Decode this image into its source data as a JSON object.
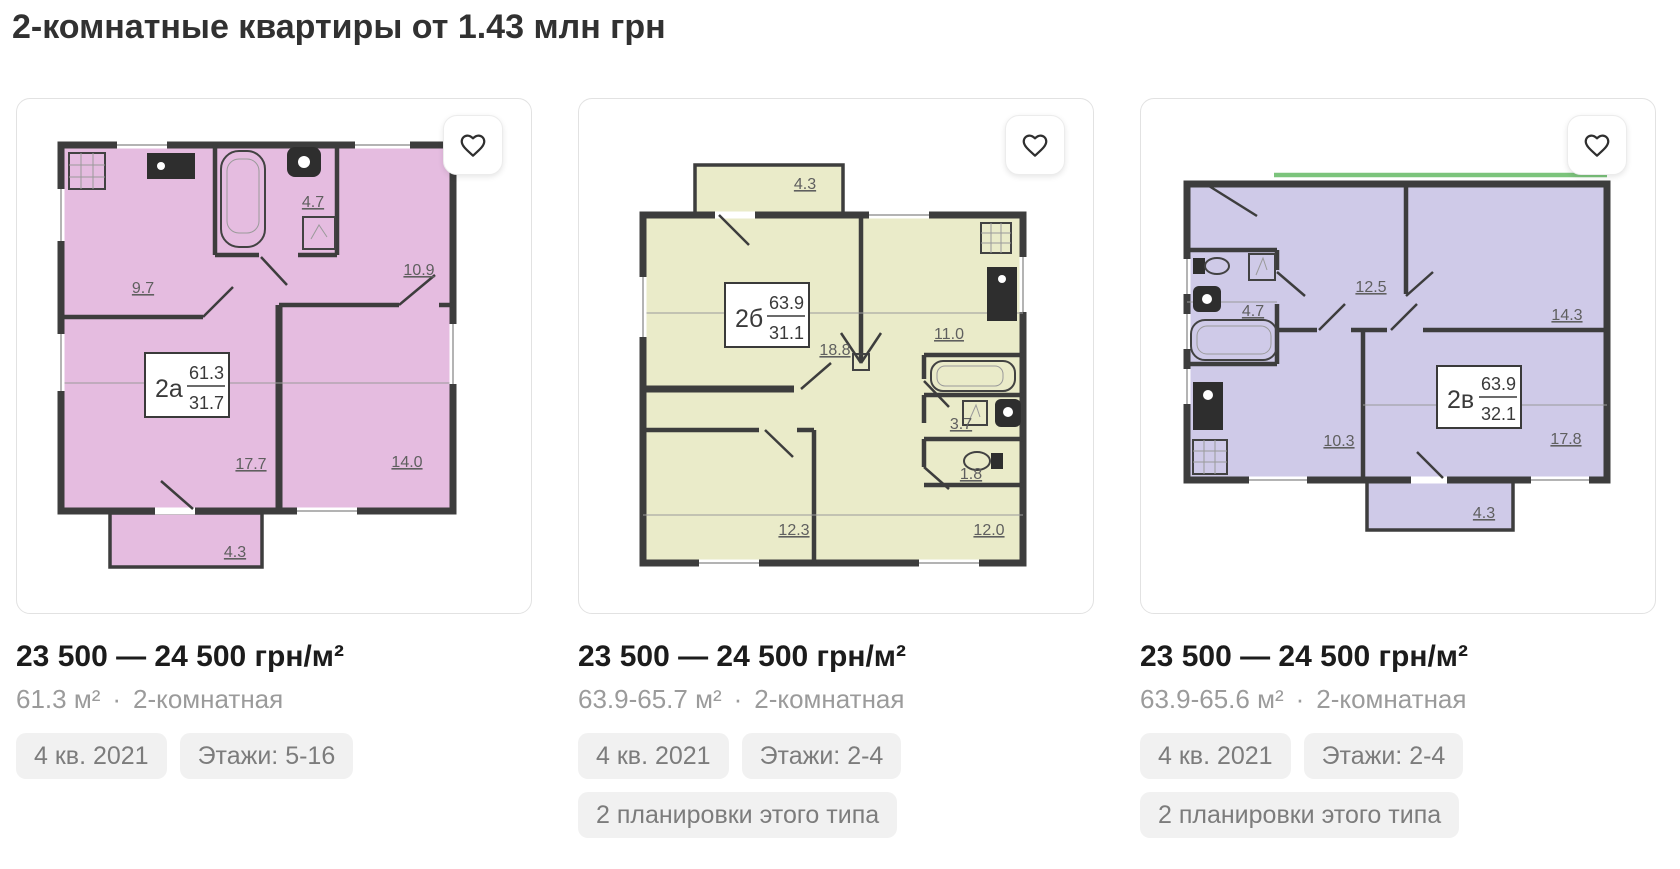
{
  "page": {
    "title": "2-комнатные квартиры от 1.43 млн грн"
  },
  "cards": [
    {
      "price": "23 500 — 24 500 грн/м²",
      "area": "61.3 м²",
      "dot": "·",
      "rooms_text": "2-комнатная",
      "tags": [
        "4 кв. 2021",
        "Этажи: 5-16"
      ],
      "plan": {
        "type_label": "2а",
        "total_area": "61.3",
        "living_area": "31.7",
        "fill": "#e5bce0",
        "room_areas": [
          "9.7",
          "4.7",
          "10.9",
          "17.7",
          "14.0",
          "4.3"
        ]
      }
    },
    {
      "price": "23 500 — 24 500 грн/м²",
      "area": "63.9-65.7 м²",
      "dot": "·",
      "rooms_text": "2-комнатная",
      "tags": [
        "4 кв. 2021",
        "Этажи: 2-4",
        "2 планировки этого типа"
      ],
      "plan": {
        "type_label": "2б",
        "total_area": "63.9",
        "living_area": "31.1",
        "fill": "#eaebc9",
        "room_areas": [
          "4.3",
          "18.8",
          "11.0",
          "3.7",
          "1.8",
          "12.3",
          "12.0"
        ]
      }
    },
    {
      "price": "23 500 — 24 500 грн/м²",
      "area": "63.9-65.6 м²",
      "dot": "·",
      "rooms_text": "2-комнатная",
      "tags": [
        "4 кв. 2021",
        "Этажи: 2-4",
        "2 планировки этого типа"
      ],
      "plan": {
        "type_label": "2в",
        "total_area": "63.9",
        "living_area": "32.1",
        "fill": "#cfcae8",
        "accent_line": "#7cc47c",
        "room_areas": [
          "12.5",
          "14.3",
          "4.7",
          "10.3",
          "17.8",
          "4.3"
        ]
      }
    }
  ]
}
